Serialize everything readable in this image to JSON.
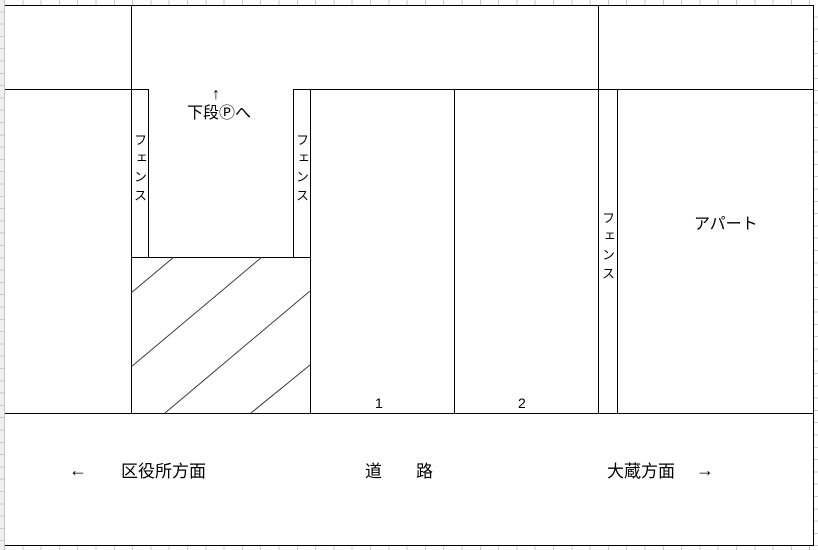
{
  "diagram": {
    "upper_exit": {
      "arrow": "↑",
      "label": "下段Ⓟへ"
    },
    "fence_left": "フェンス",
    "fence_middle": "フェンス",
    "fence_right": "フェンス",
    "apartment": "アパート",
    "spot1": "1",
    "spot2": "2",
    "road": {
      "west_arrow": "←",
      "west_label": "区役所方面",
      "label_left": "道",
      "label_right": "路",
      "east_label": "大蔵方面",
      "east_arrow": "→"
    },
    "colors": {
      "line": "#000000",
      "background": "#ffffff",
      "grid_tick": "#c9c9c9"
    }
  }
}
